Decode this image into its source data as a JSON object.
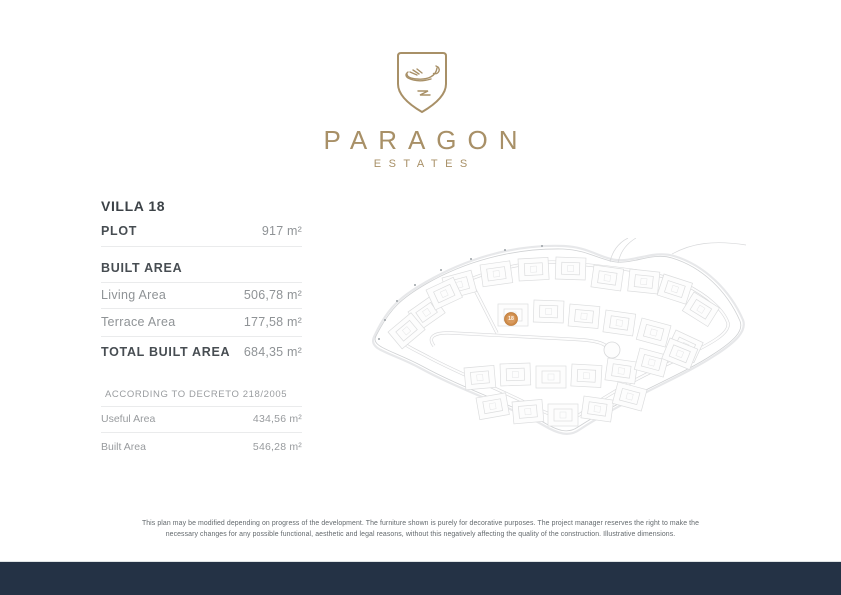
{
  "brand": {
    "name": "PARAGON",
    "subtitle": "ESTATES",
    "gold_color": "#a89067",
    "logo_icon": "swan-crest-shield-icon"
  },
  "villa": {
    "title": "VILLA 18",
    "plot": {
      "label": "PLOT",
      "value": "917 m²"
    },
    "built_area_heading": "BUILT AREA",
    "rows": [
      {
        "label": "Living Area",
        "value": "506,78 m²"
      },
      {
        "label": "Terrace Area",
        "value": "177,58 m²"
      }
    ],
    "total": {
      "label": "TOTAL BUILT AREA",
      "value": "684,35 m²"
    },
    "decreto": {
      "heading": "ACCORDING TO DECRETO 218/2005",
      "rows": [
        {
          "label": "Useful Area",
          "value": "434,56 m²"
        },
        {
          "label": "Built Area",
          "value": "546,28 m²"
        }
      ]
    }
  },
  "siteplan": {
    "marker_label": "18",
    "marker_color": "#ce8b49",
    "map_icon": "development-site-plan"
  },
  "disclaimer": {
    "line1": "This plan may be modified depending on progress of the development. The furniture shown is purely for decorative purposes. The project manager reserves the right to make the",
    "line2": "necessary changes for any possible functional, aesthetic and legal reasons, without this negatively affecting the quality of the construction. Illustrative dimensions."
  },
  "footer": {
    "bar_color": "#243245"
  }
}
